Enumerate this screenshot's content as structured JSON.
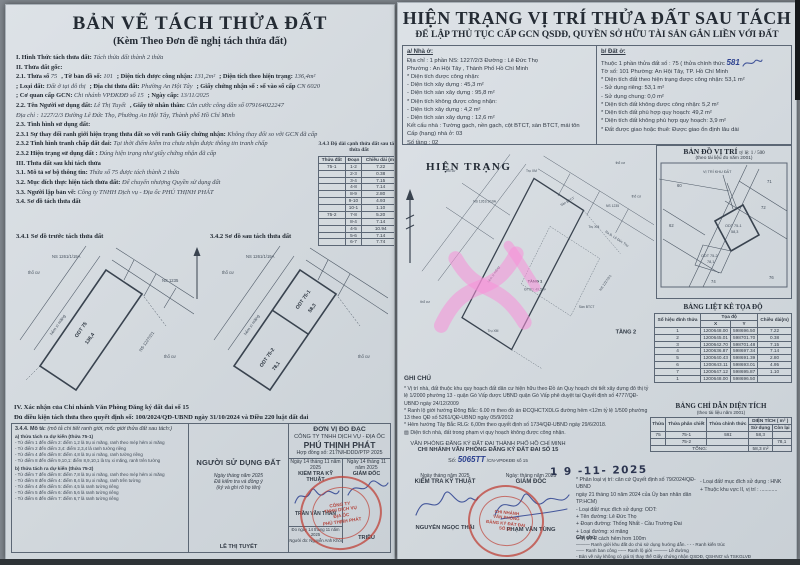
{
  "colors": {
    "stamp_red": "#bf4238",
    "ink_blue": "#2c418f",
    "highlight_pink": "#f78fd8",
    "paper": "#d6dbe0"
  },
  "left": {
    "title": "BẢN VẼ TÁCH THỬA ĐẤT",
    "subtitle": "(Kèm Theo Đơn đề nghị tách thửa đất)",
    "intro_pairs": [
      [
        {
          "l": "I. Hình Thức tách thửa đất:",
          "v": "Tách thửa đất thành 2 thửa"
        }
      ],
      [
        {
          "l": "II. Thửa đất gốc:",
          "v": ""
        }
      ],
      [
        {
          "l": "2.1. Thửa số",
          "v": "75"
        },
        {
          "l": ", Tờ bản đồ số:",
          "v": "101"
        },
        {
          "l": "; Diện tích được công nhận:",
          "v": "131,2m²"
        },
        {
          "l": "; Diện tích theo hiện trạng:",
          "v": "136,4m²"
        }
      ],
      [
        {
          "l": "; Loại đất:",
          "v": "Đất ở tại đô thị"
        },
        {
          "l": "; Địa chỉ thửa đất:",
          "v": "Phường An Hội Tây"
        },
        {
          "l": "; Giấy chứng nhận số : số vào sổ cấp",
          "v": "CN 6020"
        }
      ],
      [
        {
          "l": "; Cơ quan cấp GCN:",
          "v": "Chi nhánh VPĐKĐĐ số 15"
        },
        {
          "l": "; Ngày cấp:",
          "v": "13/11/2025"
        }
      ],
      [
        {
          "l": "2.2. Tên Người sử dụng đất:",
          "v": "Lê Thị Tuyết"
        },
        {
          "l": ", Giấy tờ nhân thân:",
          "v": "Căn cước công dân số 079164022247"
        }
      ],
      [
        {
          "l": "",
          "v": "Địa chỉ : 1227/2/3 Đường Lê Đức Thọ, Phường An Hội Tây, Thành phố Hồ Chí Minh"
        }
      ],
      [
        {
          "l": "2.3. Tình hình sử dụng đất:",
          "v": ""
        }
      ],
      [
        {
          "l": "2.3.1 Sự thay đổi ranh giới hiện trạng thửa đất so với ranh Giấy chứng nhận:",
          "v": "Không thay đổi so với GCN đã cấp"
        }
      ],
      [
        {
          "l": "2.3.2 Tình hình tranh chấp đất đai:",
          "v": "Tại thời điểm kiểm tra chưa nhận được thông tin tranh chấp"
        }
      ],
      [
        {
          "l": "2.3.2 Hiện trạng sử dụng đất :",
          "v": "Đúng hiện trạng như giấy chứng nhận đã cấp"
        }
      ],
      [
        {
          "l": "III. Thửa đất sau khi tách thửa",
          "v": ""
        }
      ],
      [
        {
          "l": "3.1. Mô tả sơ bộ thông tin:",
          "v": "Thửa số 75 được tách thành 2 thửa"
        }
      ],
      [
        {
          "l": "3.2. Mục đích thực hiện tách thửa đất:",
          "v": "Để chuyển nhượng Quyền sử dụng đất"
        }
      ],
      [
        {
          "l": "3.3. Người lập bản vẽ:",
          "v": "Công ty TNHH Dịch vụ - Địa ốc PHÚ THỊNH PHÁT"
        }
      ],
      [
        {
          "l": "3.4. Sơ đồ tách thửa đất",
          "v": ""
        }
      ]
    ],
    "table343": {
      "title": "3.4.3 Độ dài cạnh thửa đất sau tách thửa đất",
      "headers": [
        "Thửa đất",
        "Đoạn",
        "Chiều dài (m)"
      ],
      "rows": [
        [
          "75-1",
          "1-2",
          "7.22"
        ],
        [
          "",
          "2-3",
          "0.38"
        ],
        [
          "",
          "3-4",
          "7.15"
        ],
        [
          "",
          "4-8",
          "7.14"
        ],
        [
          "",
          "8-9",
          "2.80"
        ],
        [
          "",
          "9-10",
          "4.93"
        ],
        [
          "",
          "10-1",
          "1.10"
        ],
        [
          "75-2",
          "7-8",
          "5.20"
        ],
        [
          "",
          "8-4",
          "7.14"
        ],
        [
          "",
          "4-5",
          "10.94"
        ],
        [
          "",
          "5-6",
          "7.14"
        ],
        [
          "",
          "6-7",
          "7.74"
        ]
      ]
    },
    "d341_title": "3.4.1 Sơ đồ trước tách thửa đất",
    "d342_title": "3.4.2 Sơ đồ sau tách thửa đất",
    "sec4_title": "IV. Xác nhận của Chi nhánh Văn Phòng Đăng ký đất đai số 15",
    "sec4_line": "Đủ điều kiện tách thửa theo quyết định số: 100/2024/QĐ-UBND  ngày 31/10/2024 và Điều 220 luật đất đai",
    "desc_label": "3.4.4. Mô tả:",
    "desc_note": "(mô tả chi tiết ranh giới, mốc giới thửa đất sau tách:)",
    "desc_a_title": "a) thửa tách ra dự kiến (thửa 75-1)",
    "desc_a": [
      "- Từ điểm 1 đến điểm 2: điểm 1,2 là trụ xi măng, ranh theo mép hẻm xi măng",
      "- Từ điểm 2 đến điểm 3,4: điểm 2,3,4 là ranh tường riêng",
      "- Từ điểm 4 đến điểm 8: điểm 4,8 là trụ xi măng, ranh tường riêng",
      "- Từ điểm 8 đến điểm 9,10,1: điểm 8,9,10,1 là trụ xi măng, ranh trên tường"
    ],
    "desc_b_title": "b) thửa tách ra dự kiến (thửa 75-2)",
    "desc_b": [
      "- Từ điểm 7 đến điểm 8: điểm 7,8 là trụ xi măng, ranh theo mép hẻm xi măng",
      "- Từ điểm 8 đến điểm 4: điểm 8,4 là trụ xi măng, ranh trên tường",
      "- Từ điểm 4 đến điểm 5: điểm 4,5 là ranh tường riêng",
      "- Từ điểm 5 đến điểm 6: điểm 5,6 là ranh tường riêng",
      "- Từ điểm 6 đến điểm 7: điểm 6,7 là ranh tường riêng"
    ],
    "sign": {
      "user_header": "NGƯỜI SỬ DỤNG ĐẤT",
      "unit_header": "ĐƠN VỊ ĐO ĐẠC",
      "company1": "CÔNG TY TNHH DỊCH VỤ - ĐỊA ỐC",
      "company2": "PHÚ THỊNH PHÁT",
      "contract": "Hợp đồng số:   217N/HDDD/PTP 2025",
      "user_date": "Ngày   tháng   năm 2025",
      "user_note1": "Đã kiểm tra và đồng ý",
      "user_note2": "(ký và ghi rõ họ tên)",
      "user_name": "LÊ THỊ TUYẾT",
      "kt_date": "Ngày 14 tháng 11 năm 2025",
      "kt_title": "KIỂM TRA KỸ THUẬT",
      "kt_name": "TRẦN VĂN THAN",
      "kt_note1": "Đo ngày 14 tháng 11 năm 2025",
      "kt_note2": "Người đo: Nguyễn Anh Khôi",
      "gd_date": "Ngày 14 tháng 11 năm 2025",
      "gd_title": "GIÁM ĐỐC",
      "gd_name": "TRIỀU",
      "stamp_l1": "CÔNG TY",
      "stamp_l2": "TNHH DỊCH VỤ",
      "stamp_l3": "ĐỊA ỐC",
      "stamp_l4": "PHÚ THỊNH PHÁT"
    }
  },
  "right": {
    "title": "HIỆN TRẠNG VỊ TRÍ THỬA ĐẤT SAU TÁCH",
    "subtitle": "ĐỂ LẬP THỦ TỤC CẤP GCN QSDĐ, QUYỀN SỞ HỮU TÀI SẢN GẮN LIỀN VỚI ĐẤT",
    "house": {
      "header": "a/ Nhà ở:",
      "pairs": [
        [
          {
            "l": "Địa chỉ :",
            "v": "1 phần NS: 1227/2/3  Đường :  Lê Đức Thọ"
          }
        ],
        [
          {
            "l": "Phường :",
            "v": "An Hội Tây , Thành Phố Hồ Chí Minh"
          }
        ],
        [
          {
            "l": "* Diện tích được công nhận:",
            "v": ""
          }
        ],
        [
          {
            "l": "- Diện tích xây dựng :",
            "v": "45,3   m²"
          }
        ],
        [
          {
            "l": "- Diện tích sàn xây dựng :",
            "v": "95,8   m²"
          }
        ],
        [
          {
            "l": "* Diện tích không được công nhận:",
            "v": ""
          }
        ],
        [
          {
            "l": "- Diện tích xây dựng :",
            "v": "4,2   m²"
          }
        ],
        [
          {
            "l": "- Diện tích sàn xây dựng :",
            "v": "12,6   m²"
          }
        ],
        [
          {
            "l": "Kết cấu nhà :",
            "v": "Tường gạch, nền gạch, cột BTCT, sàn BTCT, mái tôn"
          }
        ],
        [
          {
            "l": "Cấp (hạng) nhà ở:",
            "v": "03"
          }
        ],
        [
          {
            "l": "Số tầng :",
            "v": "02"
          }
        ]
      ]
    },
    "land": {
      "header": "b/ Đất ở:",
      "line1_l": "Thuộc 1 phần thửa đất số :",
      "line1_v": "75  ( thửa chính thức",
      "line1_hand": "581",
      "line2_l": "Tờ số:",
      "line2_v": "101   Phường:   An Hội Tây, TP. Hồ Chí Minh",
      "pairs": [
        [
          {
            "l": "* Diện tích đất theo hiện trạng được công nhận:",
            "v": "53,1  m²"
          }
        ],
        [
          {
            "l": "     - Sử dụng riêng:",
            "v": "53,1  m²"
          }
        ],
        [
          {
            "l": "     - Sử dụng chung:",
            "v": "0,0  m²"
          }
        ],
        [
          {
            "l": "* Diện tích đất không được công nhận:",
            "v": "5,2  m²"
          }
        ],
        [
          {
            "l": "* Diện tích đất phù hợp quy hoạch:",
            "v": "49,2  m²"
          }
        ],
        [
          {
            "l": "* Diện tích đất không phù hợp quy hoạch:",
            "v": "3,9  m²"
          }
        ],
        [
          {
            "l": "* Đất được giao hoặc thuê:",
            "v": "Được giao ổn định lâu dài"
          }
        ]
      ]
    },
    "hien_trang_title": "HIỆN TRẠNG",
    "map": {
      "title": "BẢN ĐỒ VỊ TRÍ",
      "scale": "tỷ lệ: 1 / 500",
      "note": "(theo tài liệu đo năm 2001)",
      "vi_tri": "VỊ TRÍ KHU ĐẤT",
      "parcels": [
        "60",
        "62",
        "71",
        "72",
        "74",
        "76"
      ]
    },
    "ghi_chu_title": "GHI CHÚ",
    "ghi_chu": [
      "* Vị trí nhà, đất thuộc khu quy hoạch đất dân cư hiện hữu theo Đồ án Quy hoạch chi tiết xây dựng đô thị tỷ lệ 1/2000 phường 13 - quận Gò Vấp được UBND quận Gò Vấp phê duyệt tại Quyết định số 4777/QĐ-UBND ngày 24/12/2009",
      "* Ranh lộ giới hướng Đông Bắc: 6.00 m theo đồ án ĐCQHCTXDLG đường hẻm <12m tỷ lệ 1/500 phường 13 theo QĐ số 5261/QĐ-UBND ngày 05/9/2012",
      "* Hẻm hướng Tây Bắc RLG: 6,00m theo quyết định số 1734/QĐ-UBND ngày 29/6/2018.",
      "▨ Diện tích nhà, đất trong phạm vi quy hoạch không được công nhận."
    ],
    "toa_do": {
      "title": "BẢNG LIỆT KÊ TỌA ĐỘ",
      "col_id": "Số hiệu đỉnh thửa",
      "col_xy": "Tọa độ",
      "col_x": "X",
      "col_y": "Y",
      "col_len": "Chiều dài(m)",
      "rows": [
        [
          "1",
          "1200648.00",
          "598696.50",
          "7.22"
        ],
        [
          "2",
          "1200645.01",
          "598701.70",
          "0.38"
        ],
        [
          "3",
          "1200642.70",
          "598701.48",
          "7.15"
        ],
        [
          "4",
          "1200636.87",
          "598697.34",
          "7.14"
        ],
        [
          "5",
          "1200640.43",
          "598691.39",
          "2.80"
        ],
        [
          "6",
          "1200643.11",
          "598693.01",
          "4.95"
        ],
        [
          "7",
          "1200647.12",
          "598695.87",
          "1.10"
        ],
        [
          "1",
          "1200648.00",
          "598696.50",
          ""
        ]
      ]
    },
    "dien_tich": {
      "title": "BẢNG CHỈ DẪN DIỆN TÍCH",
      "note": "(theo tài liệu năm 2001)",
      "col_thua": "Thửa",
      "col_pc": "Thửa phân chiết",
      "col_ct": "Thửa chính thức",
      "col_dt": "DIỆN TÍCH ( m² )",
      "col_sd": "Sử dụng",
      "col_cl": "Còn lại",
      "r1_thua": "75",
      "r1_pc": "75-1",
      "r1_ct_hand": "581",
      "r1_sd": "58,3",
      "r1_cl": "",
      "r2_thua": "",
      "r2_pc": "75-2",
      "r2_ct": "",
      "r2_sd": "",
      "r2_cl": "78,1",
      "total_label": "TỔNG:",
      "total_value": "58,3 m²"
    },
    "office": {
      "line1": "VĂN PHÒNG ĐĂNG KÝ ĐẤT ĐAI THÀNH PHỐ HỒ CHÍ MINH",
      "line2": "CHI NHÁNH VĂN PHÒNG ĐĂNG KÝ ĐẤT ĐAI SỐ 15",
      "so_label": "Số:",
      "so_hand": "5065TT",
      "so_suffix": "/CN-VPĐKĐĐ số 15",
      "date_stamp": "1 9 -11- 2025",
      "kt_date": "Ngày   tháng   năm 2025",
      "kt_title": "KIỂM TRA KỸ THUẬT",
      "kt_name": "NGUYỄN NGỌC THÁI",
      "gd_date": "Ngày:  tháng   năm 2025",
      "gd_title": "GIÁM ĐỐC",
      "gd_name": "PHẠM VĂN TÙNG",
      "stamp_l1": "CHI NHÁNH",
      "stamp_l2": "VĂN PHÒNG",
      "stamp_l3": "ĐĂNG KÝ ĐẤT ĐAI",
      "stamp_l4": "SỐ 15"
    },
    "class_a": [
      "* Phân loại vị trí: căn cứ Quyết định số 79/2024/QĐ-UBND",
      "ngày 21 tháng 10 năm 2024 của Ủy ban nhân dân TP.HCM)",
      "- Loại đất/ mục đích sử dụng: ODT:",
      "+ Tên đường: Lê Đức Thọ",
      "+ Đoạn đường: Thống Nhất - Cầu Trường Đai",
      "+ Loại đường: xi măng",
      "+ Vị trí: 2 cách hẻm hơn 100m"
    ],
    "class_b": [
      "- Loại đất/ mục đích sử dụng : HNK",
      "+ Thuộc khu vực II, vị trí : ............"
    ],
    "legend_title": "Ghi chú:",
    "legend": [
      "——— Ranh giới khu đất do chủ sử dụng hướng dẫn.     - - -  Ranh kiến trúc",
      "┄┄┄ Ranh ban công      ╌╌╌ Ranh lộ giới      ——— Lề đường",
      "- Bản vẽ này không có giá trị thay thế Giấy chứng nhận QSDĐ, QSHNƠ và TSKGLVĐ"
    ]
  },
  "diagram": {
    "tho_cu": "thổ cư",
    "ns_19a": "NS 1261/1/19A",
    "ns_1235": "NS 1235",
    "ns_1227": "NS 1227/2/1",
    "hem": "hẻm xi măng",
    "tru_xm": "Trụ XM",
    "ra_duong": "Ra Đ. Lê Đức Thọ",
    "parcel_75": "ODT 75",
    "area_75": "136,4",
    "parcel_751": "ODT 75-1",
    "area_751": "58,3",
    "parcel_752": "ODT 75-2",
    "area_752": "78,1",
    "tang1": "TẦNG 1",
    "tang1_area": "ĐTXD: 49,5m²",
    "tang2": "TẦNG 2",
    "san_btct": "Sàn BTCT",
    "vi_tri_khu_dat": "VỊ TRÍ KHU ĐẤT"
  }
}
